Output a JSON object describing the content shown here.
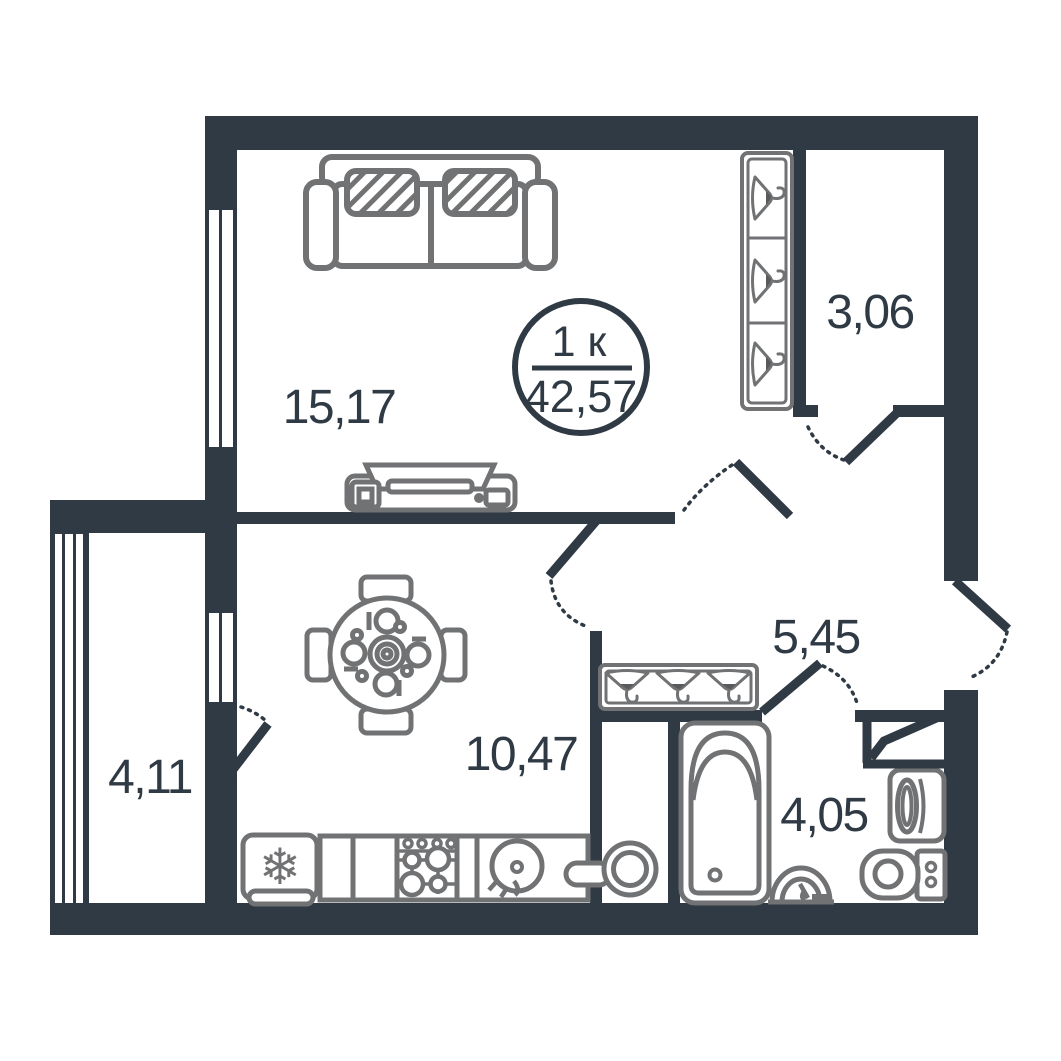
{
  "plan": {
    "title": "one-room-apartment-floor-plan",
    "badge": {
      "rooms_count": "1 к",
      "total_area": "42,57"
    },
    "rooms": {
      "living": {
        "area": "15,17"
      },
      "wardrobe": {
        "area": "3,06"
      },
      "hallway": {
        "area": "5,45"
      },
      "kitchen": {
        "area": "10,47"
      },
      "balcony": {
        "area": "4,11"
      },
      "bathroom": {
        "area": "4,05"
      }
    },
    "icons": {
      "snowflake": "❄",
      "furniture": [
        "sofa",
        "tv-stand",
        "dining-table",
        "wardrobe-hangers",
        "coat-rack",
        "fridge",
        "stove",
        "kitchen-sink",
        "corner-sink",
        "bathtub",
        "washbasin",
        "toilet",
        "washing-machine",
        "vent-shaft"
      ]
    },
    "colors": {
      "wall": "#2f3a45",
      "furniture": "#717274",
      "background": "#ffffff"
    }
  }
}
